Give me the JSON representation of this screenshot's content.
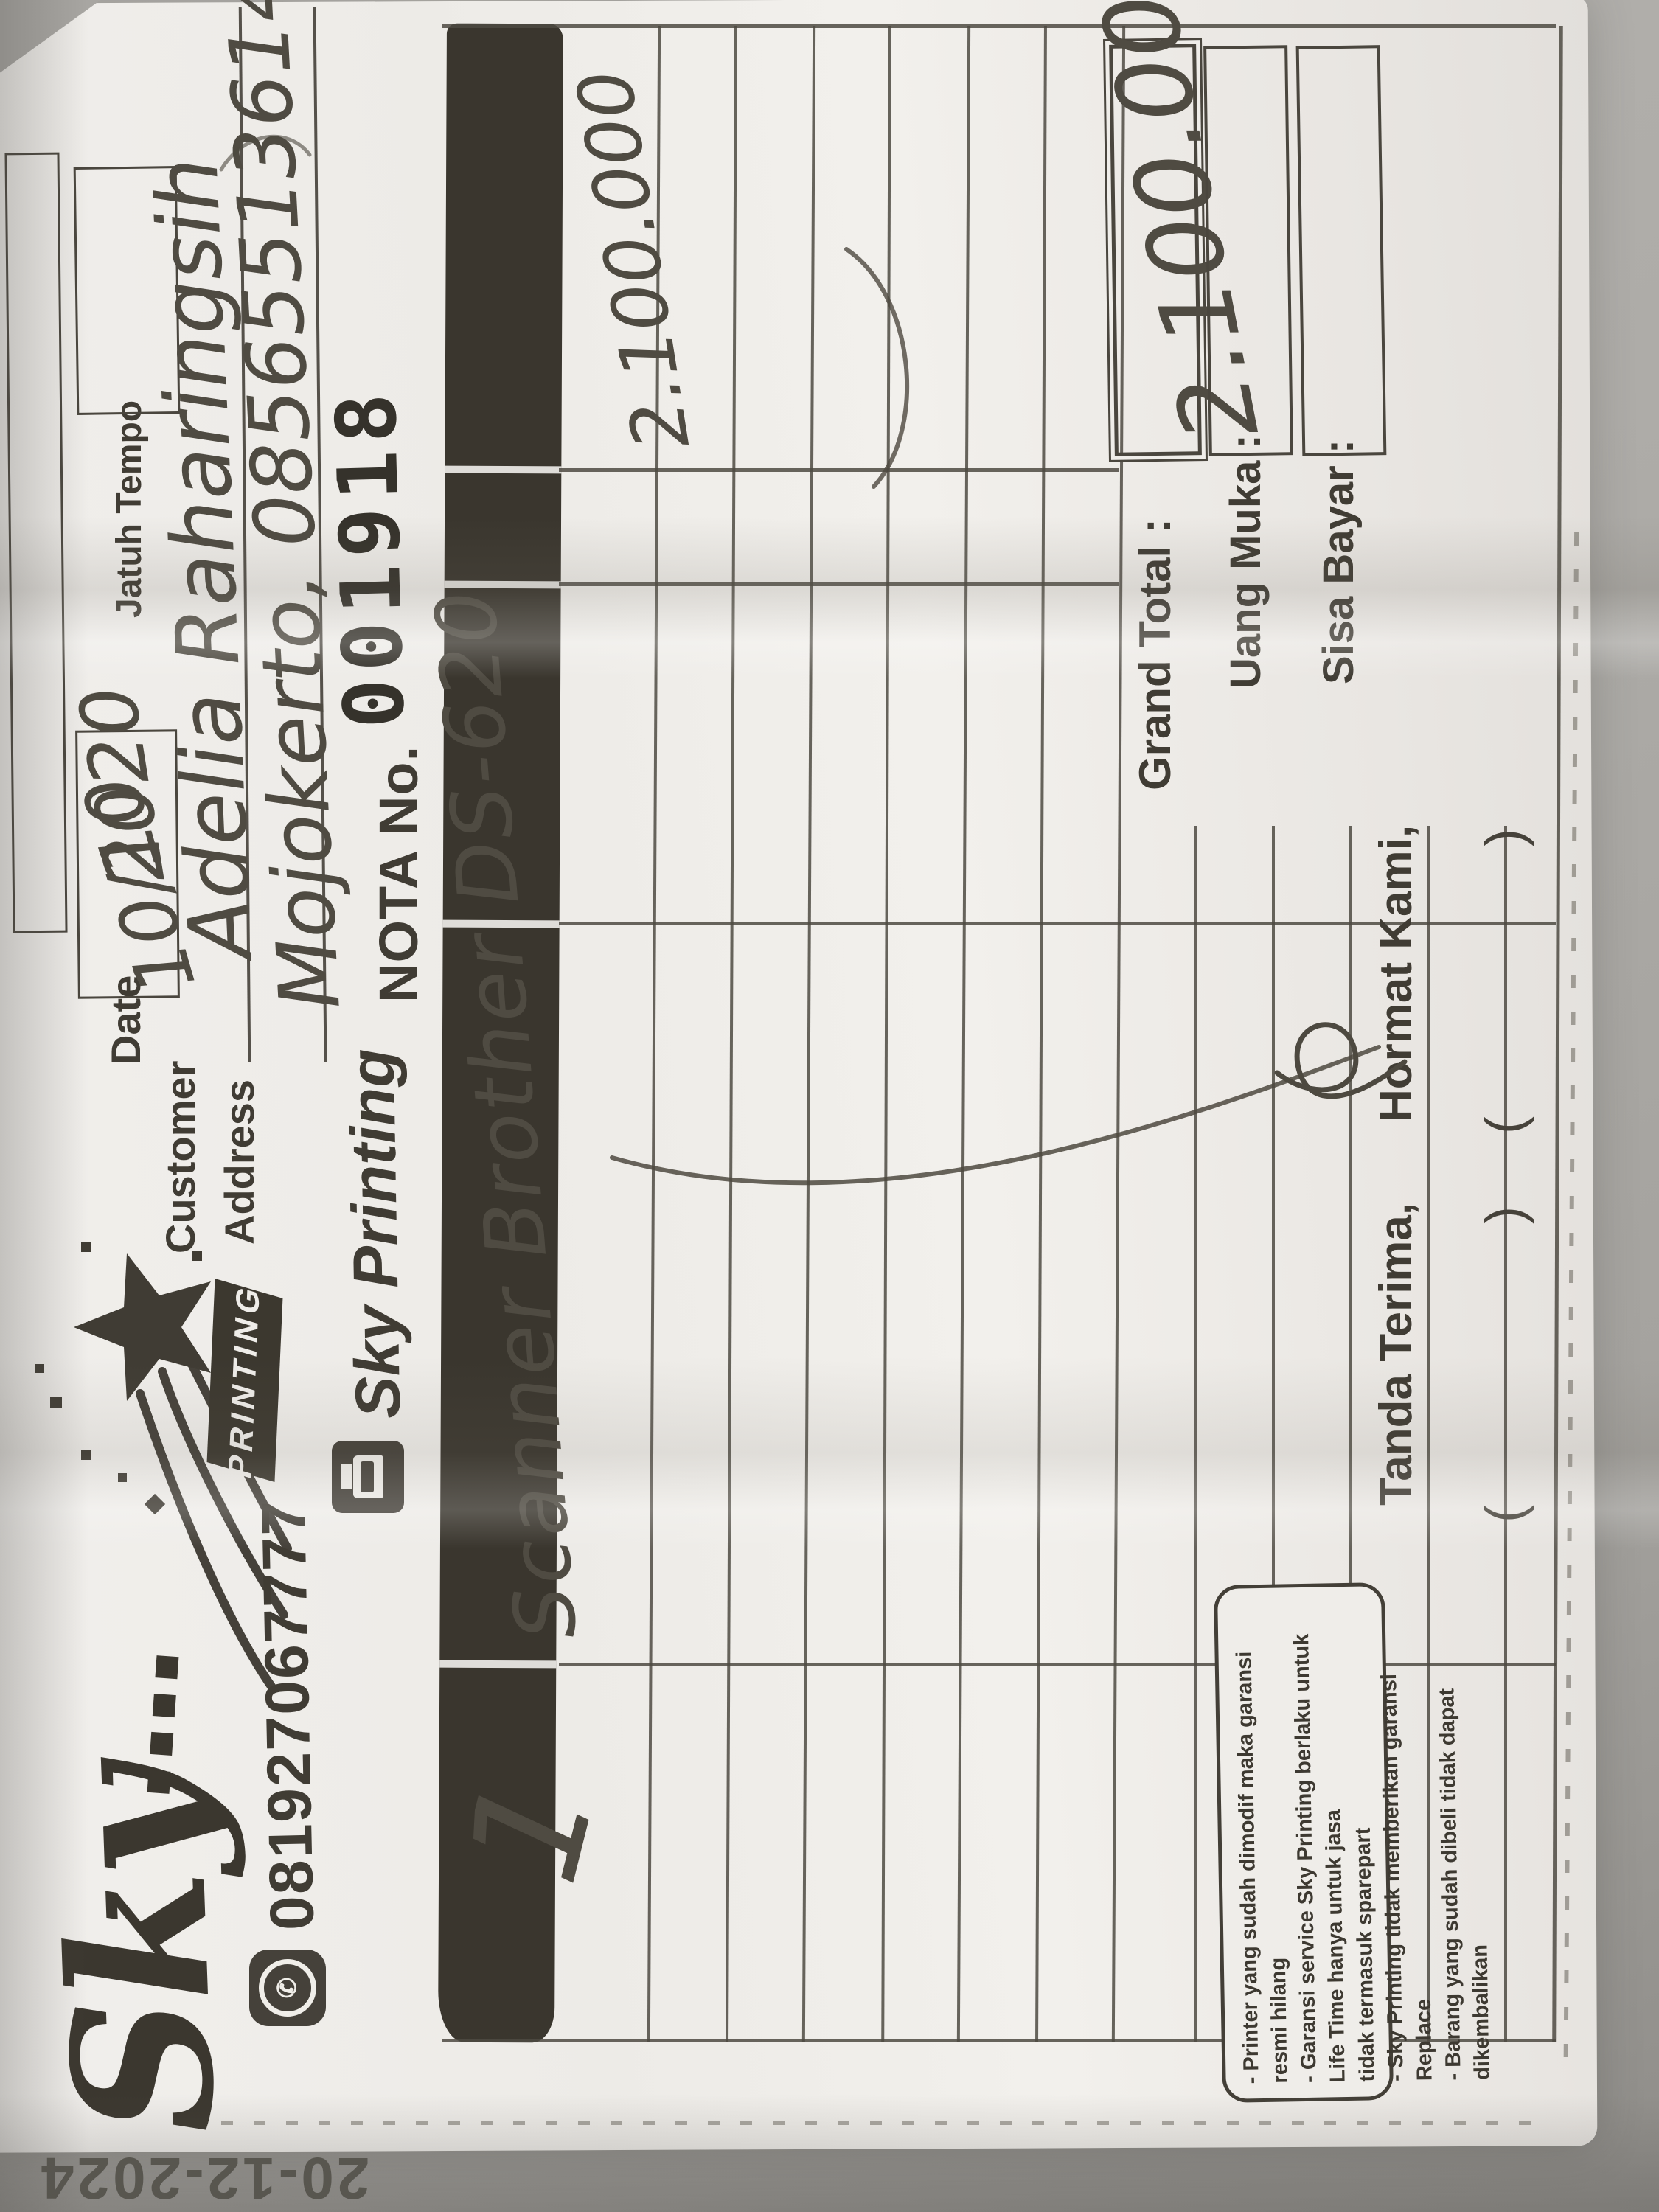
{
  "stamp": {
    "date": "20-12-2024"
  },
  "logo": {
    "brand": "Sky",
    "ribbon": "PRINTING"
  },
  "contact": {
    "phone": "081927067777"
  },
  "title": {
    "company": "Sky Printing",
    "nota_label": "NOTA No.",
    "nota_number": "001918"
  },
  "header": {
    "date_label": "Date",
    "date_value": "10/10",
    "date_year": "2020",
    "jatuh_tempo_label": "Jatuh Tempo",
    "customer_label": "Customer",
    "customer_value": "Adelia Raharingsih",
    "address_label": "Address",
    "address_value": "Mojokerto, 085655136144"
  },
  "table": {
    "item": {
      "qty": "1",
      "name": "Scanner Brother DS-620",
      "amount": "2.100.000"
    }
  },
  "footer": {
    "tanda_terima_label": "Tanda Terima,",
    "hormat_kami_label": "Hormat Kami,",
    "grand_total_label": "Grand Total :",
    "grand_total_value": "2.100.000",
    "uang_muka_label": "Uang Muka :",
    "sisa_bayar_label": "Sisa Bayar :",
    "paren_left": "(",
    "paren_right": ")",
    "terms": [
      "- Printer yang sudah dimodif maka garansi resmi hilang",
      "- Garansi service Sky Printing berlaku untuk Life Time hanya untuk jasa",
      "  tidak termasuk sparepart",
      "- Sky Printing tidak memberikan garansi Replace",
      "- Barang yang sudah dibeli tidak dapat dikembalikan"
    ]
  }
}
